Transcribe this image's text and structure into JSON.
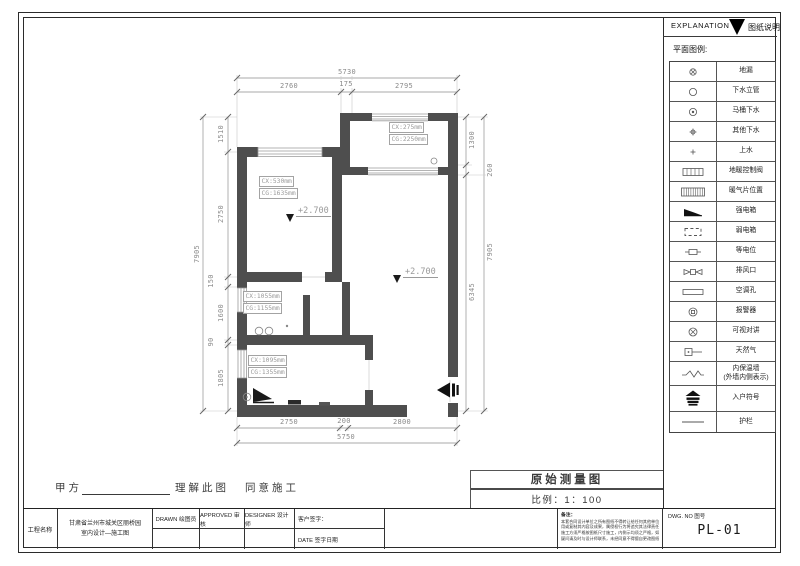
{
  "legend": {
    "header_en": "EXPLANATION",
    "header_cn": "图纸说明",
    "subtitle": "平面图例:",
    "items": [
      {
        "symbol": "floor-drain",
        "label": "地漏"
      },
      {
        "symbol": "drain-riser",
        "label": "下水立管"
      },
      {
        "symbol": "toilet-drain",
        "label": "马桶下水"
      },
      {
        "symbol": "other-drain",
        "label": "其他下水"
      },
      {
        "symbol": "water-supply",
        "label": "上水"
      },
      {
        "symbol": "heating-valve",
        "label": "地暖控制阀"
      },
      {
        "symbol": "radiator",
        "label": "暖气片位置"
      },
      {
        "symbol": "power-box",
        "label": "强电箱"
      },
      {
        "symbol": "lv-box",
        "label": "弱电箱"
      },
      {
        "symbol": "equipotential",
        "label": "等电位"
      },
      {
        "symbol": "exhaust",
        "label": "排风口"
      },
      {
        "symbol": "ac-hole",
        "label": "空调孔"
      },
      {
        "symbol": "alarm",
        "label": "报警器"
      },
      {
        "symbol": "intercom",
        "label": "可视对讲"
      },
      {
        "symbol": "gas",
        "label": "天然气"
      },
      {
        "symbol": "insulation",
        "label": "内保温墙\n(外墙内侧表示)"
      },
      {
        "symbol": "entry",
        "label": "入户符号"
      },
      {
        "symbol": "rail",
        "label": "护栏"
      }
    ]
  },
  "plan": {
    "dims": [
      {
        "t": "5730",
        "x": 347,
        "y": 72
      },
      {
        "t": "2760",
        "x": 289,
        "y": 86
      },
      {
        "t": "175",
        "x": 346,
        "y": 84
      },
      {
        "t": "2795",
        "x": 404,
        "y": 86
      },
      {
        "t": "7905",
        "x": 197,
        "y": 254,
        "r": -90
      },
      {
        "t": "1510",
        "x": 221,
        "y": 134,
        "r": -90
      },
      {
        "t": "2750",
        "x": 221,
        "y": 214,
        "r": -90
      },
      {
        "t": "150",
        "x": 211,
        "y": 281,
        "r": -90
      },
      {
        "t": "1600",
        "x": 221,
        "y": 313,
        "r": -90
      },
      {
        "t": "90",
        "x": 211,
        "y": 342,
        "r": -90
      },
      {
        "t": "1805",
        "x": 221,
        "y": 378,
        "r": -90
      },
      {
        "t": "1300",
        "x": 472,
        "y": 140,
        "r": -90
      },
      {
        "t": "260",
        "x": 490,
        "y": 170,
        "r": -90
      },
      {
        "t": "6345",
        "x": 472,
        "y": 292,
        "r": -90
      },
      {
        "t": "7905",
        "x": 490,
        "y": 252,
        "r": -90
      },
      {
        "t": "2750",
        "x": 289,
        "y": 422
      },
      {
        "t": "200",
        "x": 344,
        "y": 421
      },
      {
        "t": "2800",
        "x": 402,
        "y": 422
      },
      {
        "t": "5750",
        "x": 346,
        "y": 437
      }
    ],
    "feature_labels": [
      {
        "lines": [
          "CX:530mm",
          "CG:1635mm"
        ],
        "x": 259,
        "y": 176
      },
      {
        "lines": [
          "CX:275mm",
          "CG:2250mm"
        ],
        "x": 389,
        "y": 122
      },
      {
        "lines": [
          "CX:1055mm",
          "CG:1155mm"
        ],
        "x": 243,
        "y": 291
      },
      {
        "lines": [
          "CX:1095mm",
          "CG:1355mm"
        ],
        "x": 248,
        "y": 355
      }
    ],
    "levels": [
      {
        "text": "+2.700",
        "x": 286,
        "y": 206
      },
      {
        "text": "+2.700",
        "x": 393,
        "y": 267
      }
    ]
  },
  "titlebar": {
    "drawing_title": "原始测量图",
    "scale_label": "比例：1：100"
  },
  "approval": {
    "party_a": "甲方",
    "understand": "理解此图",
    "agree": "同意施工"
  },
  "titleblock": {
    "project_label": "工程名称",
    "project_name_line1": "甘肃省兰州市城关区丽桥园",
    "project_name_line2": "室内设计—施工图",
    "drawn": "DRAWN 绘图员",
    "approved": "APPROVED 审核",
    "designer": "DESIGNER 设计师",
    "client_sign": "客户签字：",
    "date": "DATE 签字日期",
    "notes_title": "备注：",
    "notes_lines": [
      "本套合同设计单位之所有图纸不得转让给任何其他单位使",
      "用或复制其内容及成果，属侵权行为将追究其法律责任，",
      "施工方须严格按图纸尺寸施工，内侧示均须之严格，如有",
      "疑问请及时与设计师联系，未经同意不得擅自更改图纸。"
    ],
    "dwg_no_label": "DWG. NO  图号",
    "dwg_no": "PL-01"
  },
  "colors": {
    "wall": "#4e4e4e",
    "dim_line": "#8f8f8f",
    "accent_black": "#111111"
  }
}
